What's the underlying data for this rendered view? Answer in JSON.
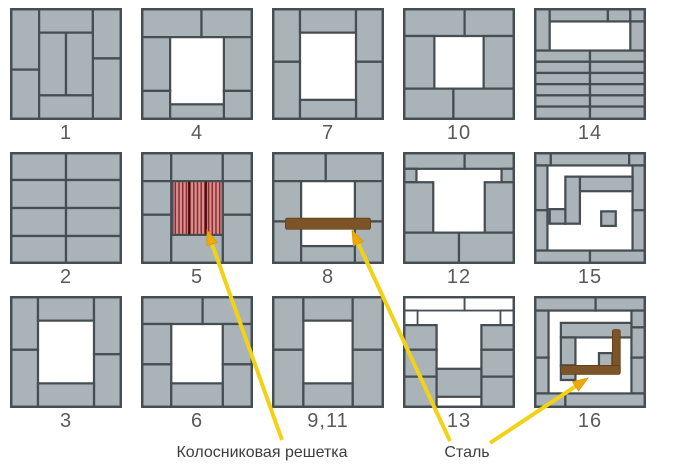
{
  "annotations": {
    "grate_label": "Колосниковая решетка",
    "steel_label": "Сталь"
  },
  "colors": {
    "brick": "#a9b3b8",
    "line": "#454e52",
    "white_brick": "#fdfdfd",
    "grate_bg": "#d78f8f",
    "grate_stripe": "#8c2b2d",
    "grate_divider": "#4a1012",
    "steel": "#7d5427",
    "arrow_line": "#f2d216",
    "arrow_head": "#efa90d",
    "number": "#5a5a5a",
    "label": "#3d3d3d"
  },
  "cells": [
    {
      "number": "1",
      "shapes": [
        [
          "b",
          0,
          0,
          26,
          55
        ],
        [
          "b",
          0,
          55,
          26,
          45
        ],
        [
          "b",
          26,
          0,
          48,
          22
        ],
        [
          "b",
          74,
          0,
          26,
          45
        ],
        [
          "b",
          74,
          45,
          26,
          55
        ],
        [
          "b",
          26,
          22,
          24,
          56
        ],
        [
          "b",
          50,
          22,
          24,
          56
        ],
        [
          "b",
          26,
          78,
          48,
          22
        ]
      ]
    },
    {
      "number": "4",
      "shapes": [
        [
          "b",
          0,
          0,
          54,
          26
        ],
        [
          "b",
          54,
          0,
          46,
          26
        ],
        [
          "b",
          0,
          26,
          26,
          48
        ],
        [
          "b",
          0,
          74,
          26,
          26
        ],
        [
          "b",
          74,
          26,
          26,
          48
        ],
        [
          "b",
          74,
          74,
          26,
          26
        ],
        [
          "b",
          26,
          86,
          48,
          14
        ]
      ]
    },
    {
      "number": "7",
      "shapes": [
        [
          "b",
          0,
          0,
          25,
          48
        ],
        [
          "b",
          0,
          48,
          25,
          52
        ],
        [
          "b",
          25,
          0,
          50,
          22
        ],
        [
          "b",
          75,
          0,
          25,
          48
        ],
        [
          "b",
          75,
          48,
          25,
          52
        ],
        [
          "b",
          25,
          82,
          50,
          18
        ]
      ]
    },
    {
      "number": "10",
      "shapes": [
        [
          "b",
          0,
          0,
          55,
          25
        ],
        [
          "b",
          55,
          0,
          45,
          25
        ],
        [
          "b",
          0,
          25,
          28,
          47
        ],
        [
          "b",
          72,
          25,
          28,
          47
        ],
        [
          "b",
          0,
          72,
          45,
          28
        ],
        [
          "b",
          45,
          72,
          55,
          28
        ]
      ]
    },
    {
      "number": "14",
      "shapes": [
        [
          "b",
          0,
          0,
          14,
          38
        ],
        [
          "b",
          14,
          0,
          52,
          12
        ],
        [
          "b",
          66,
          0,
          20,
          12
        ],
        [
          "b",
          86,
          0,
          14,
          12
        ],
        [
          "b",
          86,
          12,
          14,
          26
        ],
        [
          "b",
          0,
          38,
          50,
          10
        ],
        [
          "b",
          50,
          38,
          50,
          10
        ],
        [
          "b",
          0,
          48,
          50,
          10
        ],
        [
          "b",
          50,
          48,
          50,
          10
        ],
        [
          "b",
          0,
          58,
          50,
          10
        ],
        [
          "b",
          50,
          58,
          50,
          10
        ],
        [
          "b",
          0,
          68,
          50,
          10
        ],
        [
          "b",
          50,
          68,
          50,
          10
        ],
        [
          "b",
          0,
          78,
          50,
          10
        ],
        [
          "b",
          50,
          78,
          50,
          10
        ],
        [
          "b",
          0,
          88,
          50,
          12
        ],
        [
          "b",
          50,
          88,
          50,
          12
        ]
      ]
    },
    {
      "number": "2",
      "shapes": [
        [
          "b",
          0,
          0,
          50,
          25
        ],
        [
          "b",
          50,
          0,
          50,
          25
        ],
        [
          "b",
          0,
          25,
          50,
          25
        ],
        [
          "b",
          50,
          25,
          50,
          25
        ],
        [
          "b",
          0,
          50,
          50,
          25
        ],
        [
          "b",
          50,
          50,
          50,
          25
        ],
        [
          "b",
          0,
          75,
          50,
          25
        ],
        [
          "b",
          50,
          75,
          50,
          25
        ]
      ]
    },
    {
      "number": "5",
      "shapes": [
        [
          "b",
          0,
          0,
          27,
          26
        ],
        [
          "b",
          27,
          0,
          46,
          26
        ],
        [
          "b",
          73,
          0,
          27,
          26
        ],
        [
          "b",
          0,
          26,
          27,
          30
        ],
        [
          "b",
          0,
          56,
          27,
          44
        ],
        [
          "b",
          73,
          26,
          27,
          30
        ],
        [
          "b",
          73,
          56,
          27,
          44
        ],
        [
          "b",
          27,
          74,
          46,
          26
        ],
        [
          "g",
          28,
          26,
          45,
          48
        ]
      ]
    },
    {
      "number": "8",
      "shapes": [
        [
          "b",
          0,
          0,
          48,
          26
        ],
        [
          "b",
          48,
          0,
          52,
          26
        ],
        [
          "b",
          0,
          26,
          26,
          36
        ],
        [
          "b",
          0,
          62,
          26,
          38
        ],
        [
          "b",
          74,
          26,
          26,
          36
        ],
        [
          "b",
          74,
          62,
          26,
          38
        ],
        [
          "b",
          26,
          84,
          48,
          16
        ],
        [
          "s",
          12,
          59,
          76,
          10
        ]
      ]
    },
    {
      "number": "12",
      "shapes": [
        [
          "b",
          0,
          0,
          55,
          15
        ],
        [
          "b",
          55,
          0,
          45,
          15
        ],
        [
          "b",
          0,
          15,
          12,
          12
        ],
        [
          "b",
          88,
          15,
          12,
          12
        ],
        [
          "b",
          0,
          27,
          27,
          45
        ],
        [
          "b",
          73,
          27,
          27,
          45
        ],
        [
          "b",
          0,
          72,
          50,
          28
        ],
        [
          "b",
          50,
          72,
          50,
          28
        ]
      ]
    },
    {
      "number": "15",
      "shapes": [
        [
          "b",
          0,
          0,
          15,
          12
        ],
        [
          "b",
          15,
          0,
          70,
          12
        ],
        [
          "b",
          85,
          0,
          15,
          12
        ],
        [
          "b",
          0,
          12,
          12,
          40
        ],
        [
          "b",
          0,
          52,
          12,
          36
        ],
        [
          "b",
          88,
          12,
          12,
          40
        ],
        [
          "b",
          88,
          52,
          12,
          36
        ],
        [
          "b",
          0,
          88,
          50,
          12
        ],
        [
          "b",
          50,
          88,
          50,
          12
        ],
        [
          "b",
          41,
          22,
          47,
          13
        ],
        [
          "b",
          28,
          22,
          13,
          42
        ],
        [
          "b",
          14,
          51,
          14,
          13
        ],
        [
          "b",
          60,
          53,
          13,
          13
        ]
      ]
    },
    {
      "number": "3",
      "shapes": [
        [
          "b",
          0,
          0,
          25,
          48
        ],
        [
          "b",
          0,
          48,
          25,
          52
        ],
        [
          "b",
          25,
          0,
          50,
          22
        ],
        [
          "b",
          75,
          0,
          25,
          52
        ],
        [
          "b",
          75,
          52,
          25,
          48
        ],
        [
          "b",
          25,
          78,
          50,
          22
        ]
      ]
    },
    {
      "number": "6",
      "shapes": [
        [
          "b",
          0,
          0,
          55,
          25
        ],
        [
          "b",
          55,
          0,
          45,
          25
        ],
        [
          "b",
          0,
          25,
          27,
          36
        ],
        [
          "b",
          0,
          61,
          27,
          39
        ],
        [
          "b",
          73,
          25,
          27,
          36
        ],
        [
          "b",
          73,
          61,
          27,
          39
        ],
        [
          "b",
          27,
          78,
          46,
          22
        ]
      ]
    },
    {
      "number": "9,11",
      "shapes": [
        [
          "b",
          0,
          0,
          28,
          48
        ],
        [
          "b",
          0,
          48,
          28,
          52
        ],
        [
          "b",
          28,
          0,
          44,
          22
        ],
        [
          "b",
          72,
          0,
          28,
          48
        ],
        [
          "b",
          72,
          48,
          28,
          52
        ],
        [
          "b",
          28,
          78,
          44,
          22
        ]
      ]
    },
    {
      "number": "13",
      "shapes": [
        [
          "w",
          0,
          0,
          55,
          13
        ],
        [
          "w",
          55,
          0,
          45,
          13
        ],
        [
          "w",
          0,
          13,
          13,
          13
        ],
        [
          "w",
          87,
          13,
          13,
          13
        ],
        [
          "b",
          0,
          26,
          30,
          22
        ],
        [
          "b",
          0,
          48,
          30,
          24
        ],
        [
          "b",
          0,
          72,
          30,
          28
        ],
        [
          "b",
          70,
          26,
          30,
          22
        ],
        [
          "b",
          70,
          48,
          30,
          24
        ],
        [
          "b",
          70,
          72,
          30,
          28
        ],
        [
          "b",
          30,
          65,
          40,
          25
        ]
      ]
    },
    {
      "number": "16",
      "shapes": [
        [
          "b",
          0,
          0,
          55,
          13
        ],
        [
          "b",
          55,
          0,
          45,
          13
        ],
        [
          "b",
          0,
          13,
          13,
          42
        ],
        [
          "b",
          0,
          55,
          13,
          32
        ],
        [
          "b",
          87,
          13,
          13,
          15
        ],
        [
          "b",
          87,
          28,
          13,
          27
        ],
        [
          "b",
          87,
          55,
          13,
          32
        ],
        [
          "b",
          0,
          87,
          28,
          13
        ],
        [
          "b",
          28,
          87,
          72,
          13
        ],
        [
          "b",
          24,
          24,
          63,
          13
        ],
        [
          "b",
          24,
          37,
          13,
          25
        ],
        [
          "b",
          24,
          62,
          13,
          13
        ],
        [
          "b",
          58,
          51,
          12,
          12
        ],
        [
          "s",
          70,
          30,
          7,
          39
        ],
        [
          "s",
          24,
          62,
          53,
          8
        ]
      ]
    }
  ],
  "arrows": [
    {
      "x1": 282,
      "y1": 440,
      "x2": 207,
      "y2": 230
    },
    {
      "x1": 450,
      "y1": 441,
      "x2": 352,
      "y2": 230
    },
    {
      "x1": 490,
      "y1": 443,
      "x2": 588,
      "y2": 378
    }
  ],
  "label_positions": [
    {
      "key": "grate_label",
      "x": 262,
      "y": 444
    },
    {
      "key": "steel_label",
      "x": 467,
      "y": 444
    }
  ]
}
